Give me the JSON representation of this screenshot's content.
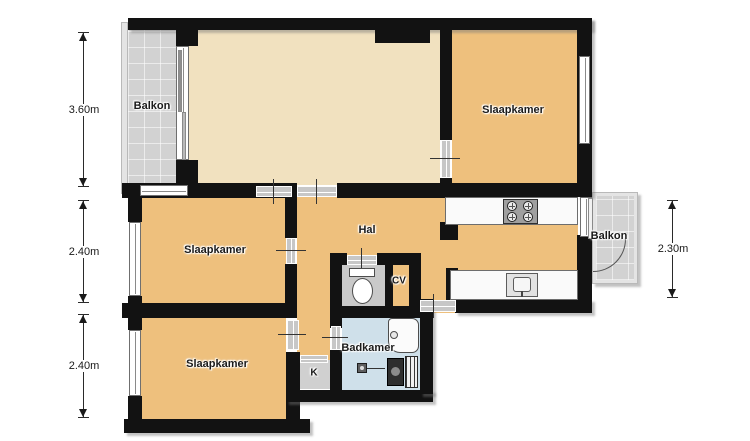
{
  "plan_title": "apartment-floor-plan",
  "colors": {
    "wall": "#121212",
    "room_orange": "#eec07d",
    "living_beige": "#f1e1bf",
    "bathroom_blue": "#cfe0ea",
    "balcony_gray": "#d2d2d2",
    "closet_gray": "#d0d0d0",
    "toilet_gray": "#c9c9c9",
    "background": "#ffffff"
  },
  "rooms": {
    "balcony_top_left": {
      "label": "Balkon"
    },
    "bedroom_top_right": {
      "label": "Slaapkamer"
    },
    "bedroom_middle_left": {
      "label": "Slaapkamer"
    },
    "bedroom_bottom_left": {
      "label": "Slaapkamer"
    },
    "hall": {
      "label": "Hal"
    },
    "cv_closet": {
      "label": "CV"
    },
    "bathroom": {
      "label": "Badkamer"
    },
    "closet": {
      "label": "K"
    },
    "balcony_right": {
      "label": "Balkon"
    }
  },
  "dimensions": {
    "left_top": "3.60m",
    "left_middle": "2.40m",
    "left_bottom": "2.40m",
    "right": "2.30m"
  },
  "fixtures": {
    "stove": "stove-icon",
    "sink": "sink-icon",
    "toilet": "toilet-icon",
    "bathtub": "bathtub-icon",
    "washing_machine": "washing-machine-icon",
    "radiator": "radiator-icon",
    "door_swing": "door-arc-icon"
  }
}
